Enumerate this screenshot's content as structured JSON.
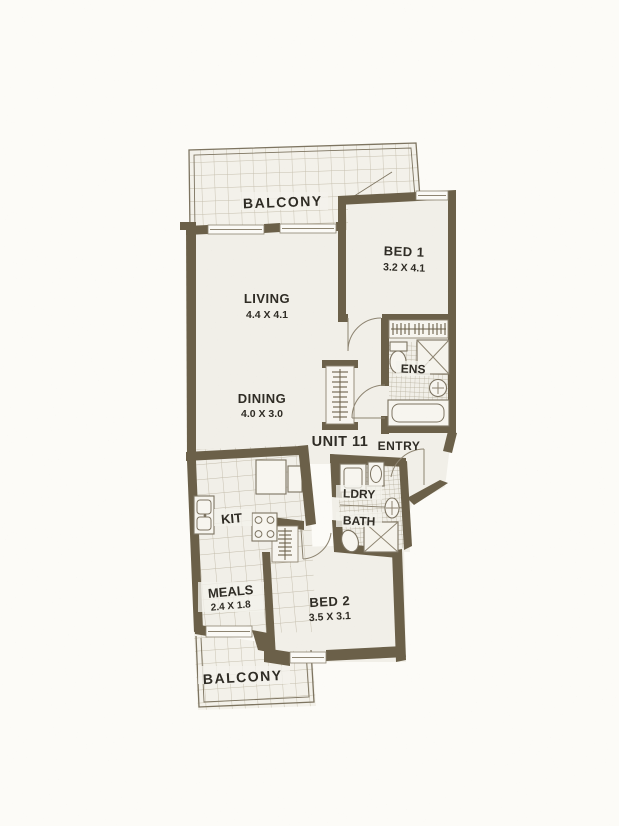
{
  "unit": {
    "label": "UNIT 11"
  },
  "rooms": {
    "balcony_top": {
      "label": "BALCONY"
    },
    "living": {
      "label": "LIVING",
      "dims": "4.4 X 4.1"
    },
    "bed1": {
      "label": "BED 1",
      "dims": "3.2 X 4.1"
    },
    "ens": {
      "label": "ENS"
    },
    "dining": {
      "label": "DINING",
      "dims": "4.0 X 3.0"
    },
    "entry": {
      "label": "ENTRY"
    },
    "kitchen": {
      "label": "KIT"
    },
    "laundry": {
      "label": "LDRY"
    },
    "bath": {
      "label": "BATH"
    },
    "meals": {
      "label": "MEALS",
      "dims": "2.4 X 1.8"
    },
    "bed2": {
      "label": "BED 2",
      "dims": "3.5 X 3.1"
    },
    "balcony_bottom": {
      "label": "BALCONY"
    }
  },
  "colors": {
    "wall": "#6b6049",
    "paper": "#fcfbf7",
    "floor": "#f1efe8",
    "tile": "#f3f1ea",
    "tile_line": "#c6bfad",
    "fixture_line": "#7c7361",
    "text": "#2f2c25"
  }
}
